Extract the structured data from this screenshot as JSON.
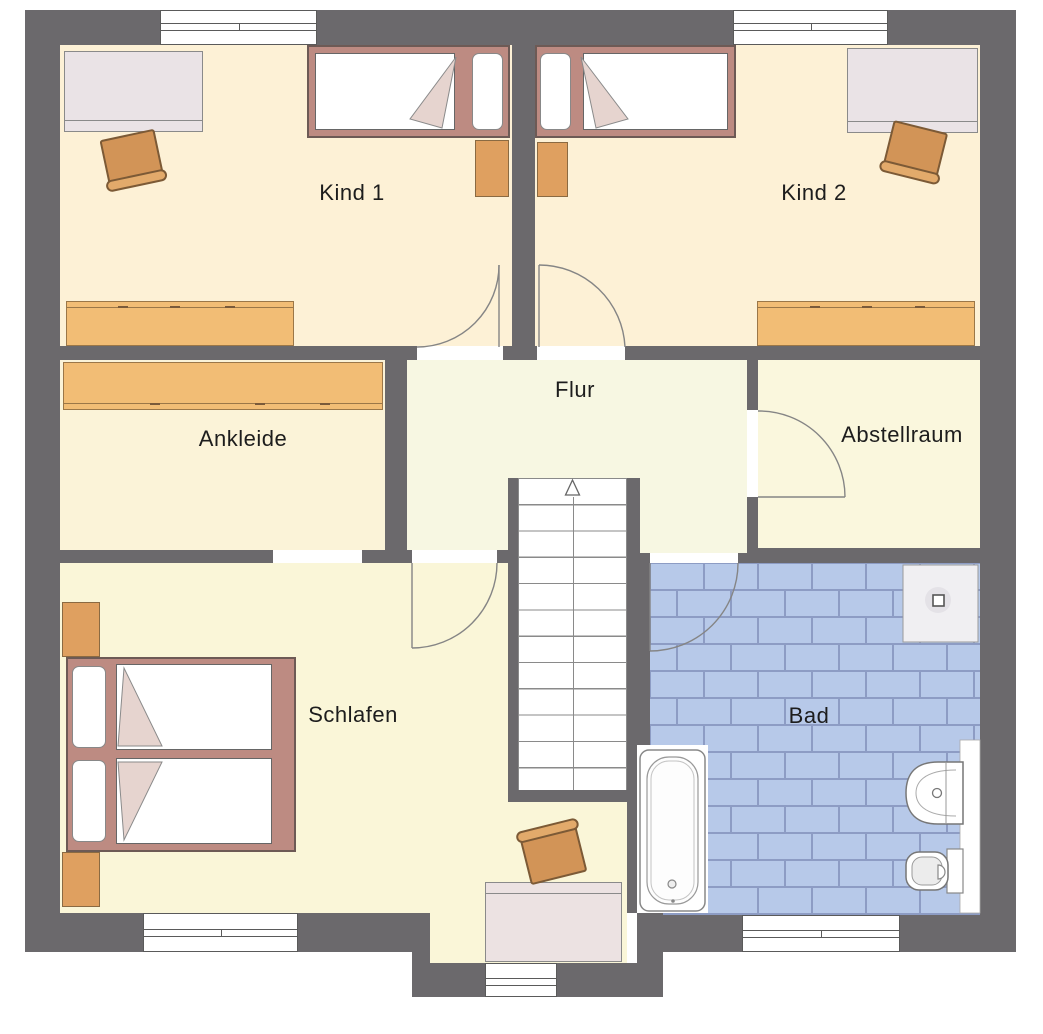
{
  "plan_title": "floor-plan-upper-storey",
  "rooms": {
    "kind1": {
      "label": "Kind 1"
    },
    "kind2": {
      "label": "Kind 2"
    },
    "flur": {
      "label": "Flur"
    },
    "ankleide": {
      "label": "Ankleide"
    },
    "abstellraum": {
      "label": "Abstellraum"
    },
    "schlafen": {
      "label": "Schlafen"
    },
    "bad": {
      "label": "Bad"
    }
  },
  "colors": {
    "wall": "#6b696c",
    "floor_kind": "#fdf1d6",
    "floor_ankleide": "#fbf3d8",
    "floor_flur": "#f7f7e2",
    "floor_abstellraum": "#faf7dd",
    "floor_schlafen": "#faf6d8",
    "tile_fill": "#b7c9e9",
    "tile_grout": "#8d9cc4",
    "bed_frame": "#bd8b82",
    "cabinet_orange": "#f2bd75",
    "chair_orange": "#d29457",
    "desk_pink": "#eae3e6",
    "fixture_white": "#ffffff"
  }
}
